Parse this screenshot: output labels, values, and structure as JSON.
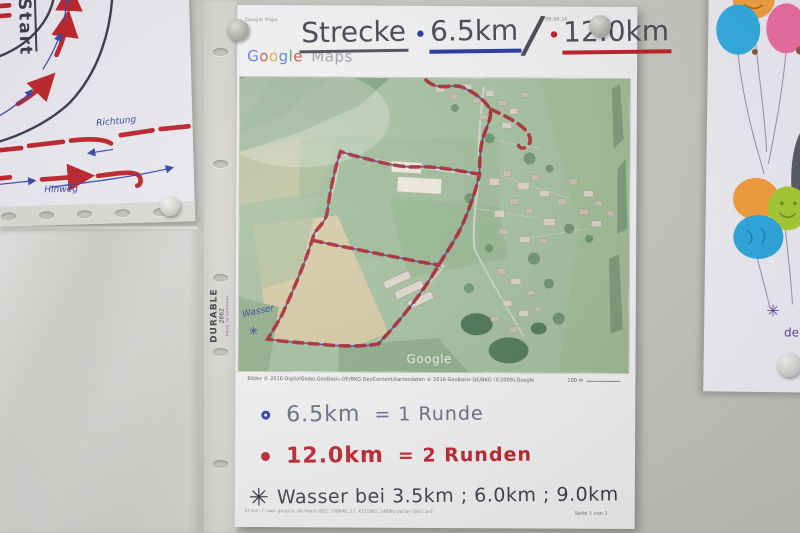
{
  "left_poster": {
    "start_label": "Start",
    "richtung_label": "Richtung",
    "hinweg_label": "Hinweg"
  },
  "sleeve": {
    "brand": "DURABLE",
    "model": "2662",
    "made_in": "MADE IN GERMANY"
  },
  "page": {
    "print_header_left": "Google Maps",
    "print_header_right": "06.06.16",
    "logo": {
      "letters": [
        {
          "ch": "G",
          "color": "#4b7be0"
        },
        {
          "ch": "o",
          "color": "#d6493d"
        },
        {
          "ch": "o",
          "color": "#e8a63c"
        },
        {
          "ch": "g",
          "color": "#4b7be0"
        },
        {
          "ch": "l",
          "color": "#4ba05c"
        },
        {
          "ch": "e",
          "color": "#d6493d"
        }
      ],
      "maps": "Maps"
    },
    "title": {
      "route_word": "Strecke",
      "bullet1": "•",
      "distance_short": "6.5km",
      "separator": "/",
      "bullet2": "•",
      "distance_long": "12.0km"
    },
    "map": {
      "watermark": "Google",
      "water_label": "Wasser",
      "water_symbol": "✳"
    },
    "attribution": "Bilder © 2016 DigitalGlobe,GeoBasis-DE/BKG,GeoContent,Kartendaten © 2016 GeoBasis-DE/BKG (©2009),Google",
    "scale_label": "100 m",
    "legend": {
      "row1": {
        "distance": "6.5km",
        "rest": "= 1 Runde"
      },
      "row2": {
        "distance": "12.0km",
        "rest": "= 2 Runden"
      },
      "row3": {
        "symbol": "✳",
        "label": "Wasser bei 3.5km ; 6.0km ; 9.0km"
      }
    },
    "footer": {
      "url": "https://www.google.de/maps/@52.198048,11.4151062,1469m/data=!3m1!1e3",
      "page_info": "Seite 1 von 1"
    }
  },
  "balloons_poster": {
    "symbol": "✳",
    "fragment_top": "5",
    "fragment_bottom": "de"
  },
  "colors": {
    "route_red": "#a82028",
    "route_blue": "#2d3f9f",
    "legend_red": "#bf2029",
    "legend_blue": "#2b3aa6",
    "title_ink": "#4c4c56",
    "hand_blue": "#3a49b0",
    "marker_red": "#c0272e"
  }
}
